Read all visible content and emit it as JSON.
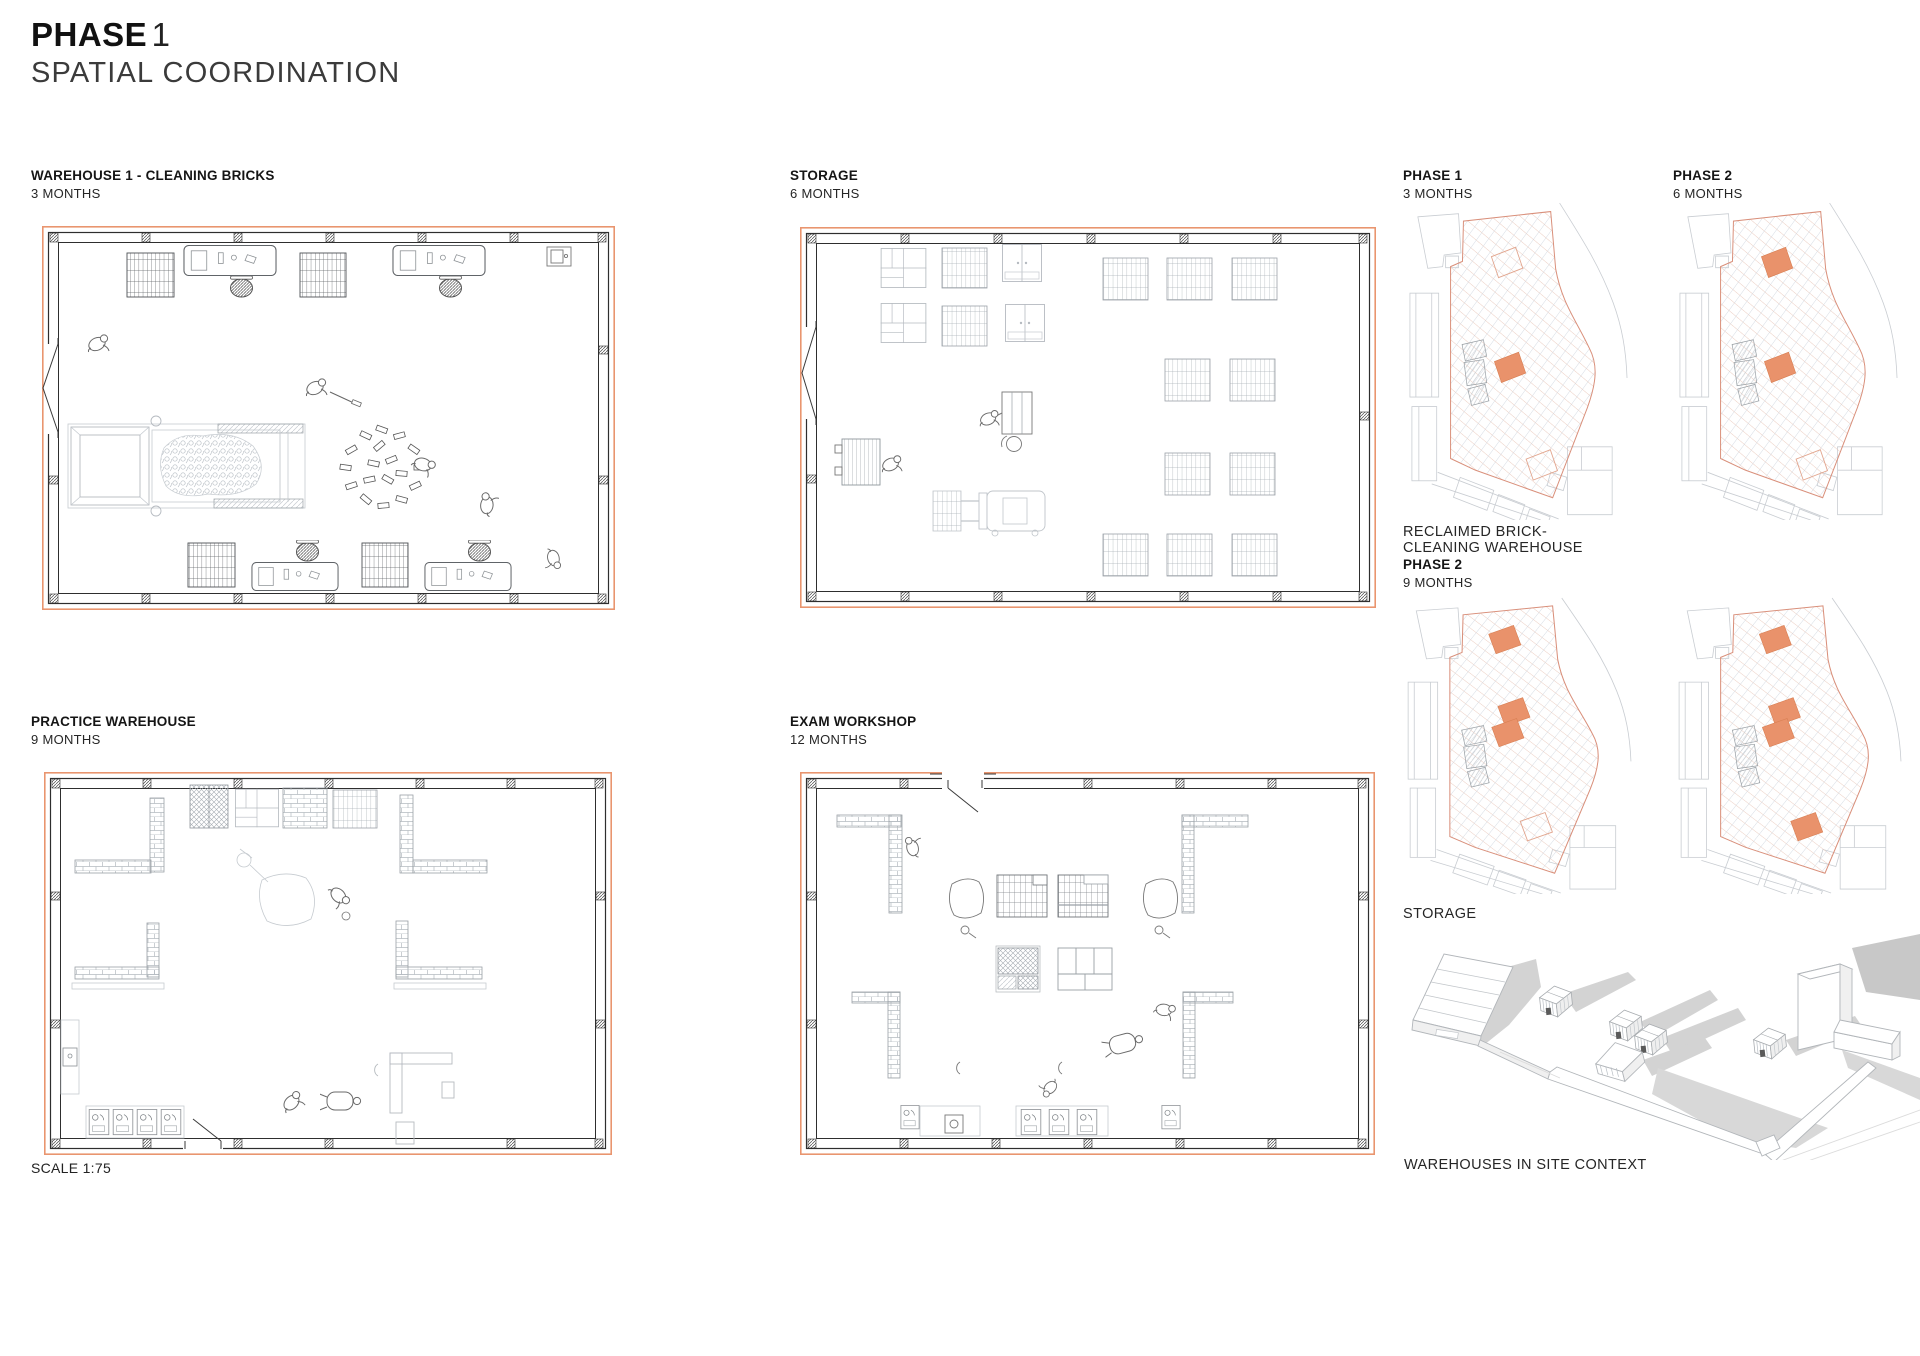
{
  "page": {
    "title_bold": "PHASE",
    "title_number": "1",
    "subtitle": "SPATIAL COORDINATION",
    "scale_note": "SCALE 1:75"
  },
  "plans": [
    {
      "label": "WAREHOUSE 1 - CLEANING BRICKS",
      "duration": "3 MONTHS"
    },
    {
      "label": "STORAGE",
      "duration": "6 MONTHS"
    },
    {
      "label": "PRACTICE WAREHOUSE",
      "duration": "9 MONTHS"
    },
    {
      "label": "EXAM WORKSHOP",
      "duration": "12 MONTHS"
    }
  ],
  "site_column": {
    "phase1_label": "PHASE 1",
    "phase1_duration": "3 MONTHS",
    "phase2_label": "PHASE 2",
    "phase2_duration": "6 MONTHS",
    "reclaimed_caption": "RECLAIMED BRICK- CLEANING WAREHOUSE",
    "phase2b_label": "PHASE 2",
    "phase2b_duration": "9 MONTHS",
    "storage_caption": "STORAGE",
    "axon_caption": "WAREHOUSES IN SITE CONTEXT",
    "highlights": [
      [
        {
          "cx": 106,
          "cy": 57,
          "filled": false
        },
        {
          "cx": 109,
          "cy": 156,
          "filled": true
        },
        {
          "cx": 141,
          "cy": 248,
          "filled": false
        }
      ],
      [
        {
          "cx": 106,
          "cy": 57,
          "filled": true
        },
        {
          "cx": 109,
          "cy": 156,
          "filled": true
        },
        {
          "cx": 141,
          "cy": 248,
          "filled": false
        }
      ],
      [
        {
          "cx": 103,
          "cy": 43,
          "filled": true
        },
        {
          "cx": 112,
          "cy": 116,
          "filled": true
        },
        {
          "cx": 106,
          "cy": 137,
          "filled": true
        },
        {
          "cx": 134,
          "cy": 232,
          "filled": false
        }
      ],
      [
        {
          "cx": 103,
          "cy": 43,
          "filled": true
        },
        {
          "cx": 112,
          "cy": 116,
          "filled": true
        },
        {
          "cx": 106,
          "cy": 137,
          "filled": true
        },
        {
          "cx": 134,
          "cy": 232,
          "filled": true
        }
      ]
    ]
  },
  "theme": {
    "accent": "#E9926B",
    "accent-line": "#E9956F",
    "site-line": "#D98F7A",
    "wall": "#2E2E2E"
  }
}
